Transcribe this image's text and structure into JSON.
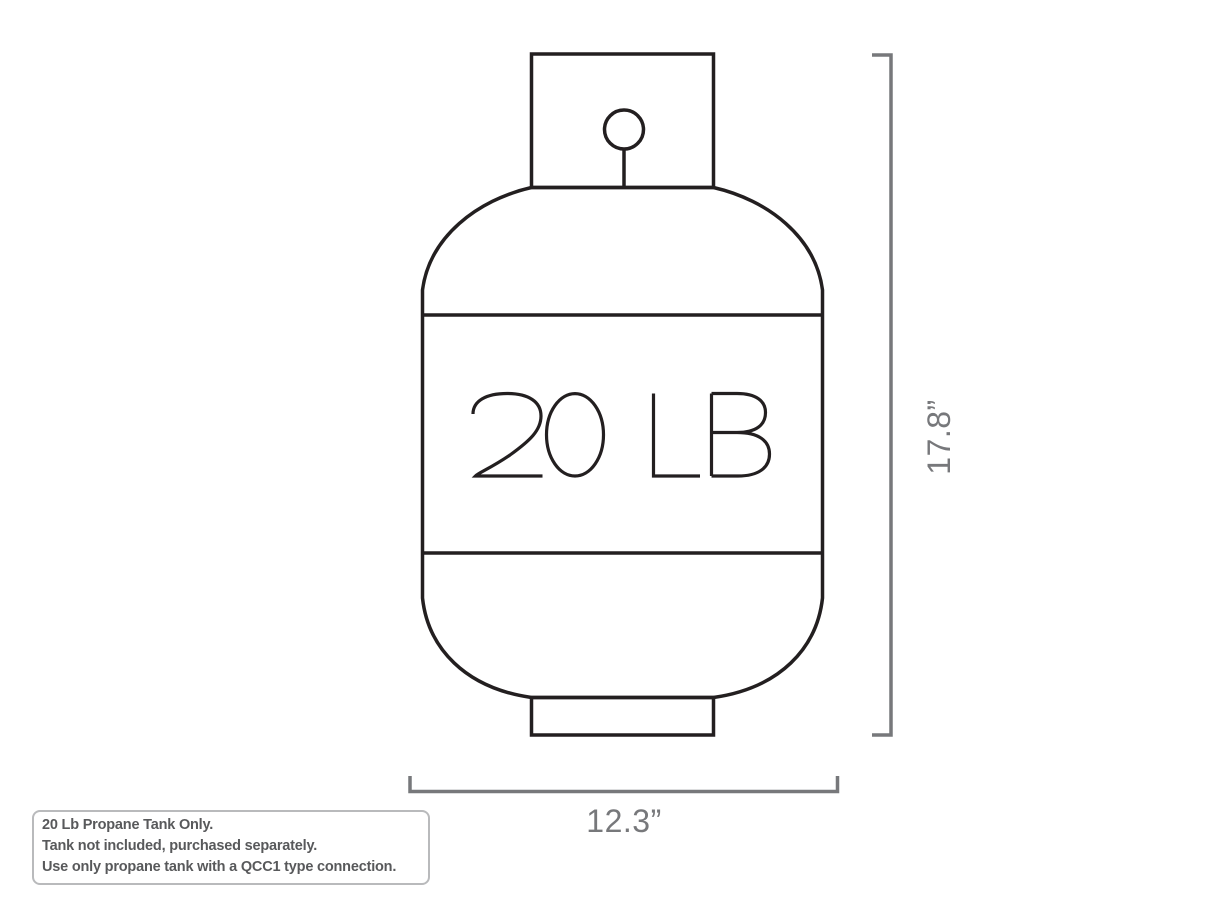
{
  "tank": {
    "weight_label": "20 LB"
  },
  "dimensions": {
    "height_label": "17.8”",
    "width_label": "12.3”"
  },
  "note": {
    "lines": [
      "20 Lb Propane Tank Only.",
      "Tank not included, purchased separately.",
      "Use only propane tank with a QCC1 type connection."
    ]
  },
  "colors": {
    "tank_outline": "#231f20",
    "dimension_gray": "#77787b",
    "note_text": "#58595b",
    "note_border": "#b9babc",
    "background": "#ffffff"
  }
}
